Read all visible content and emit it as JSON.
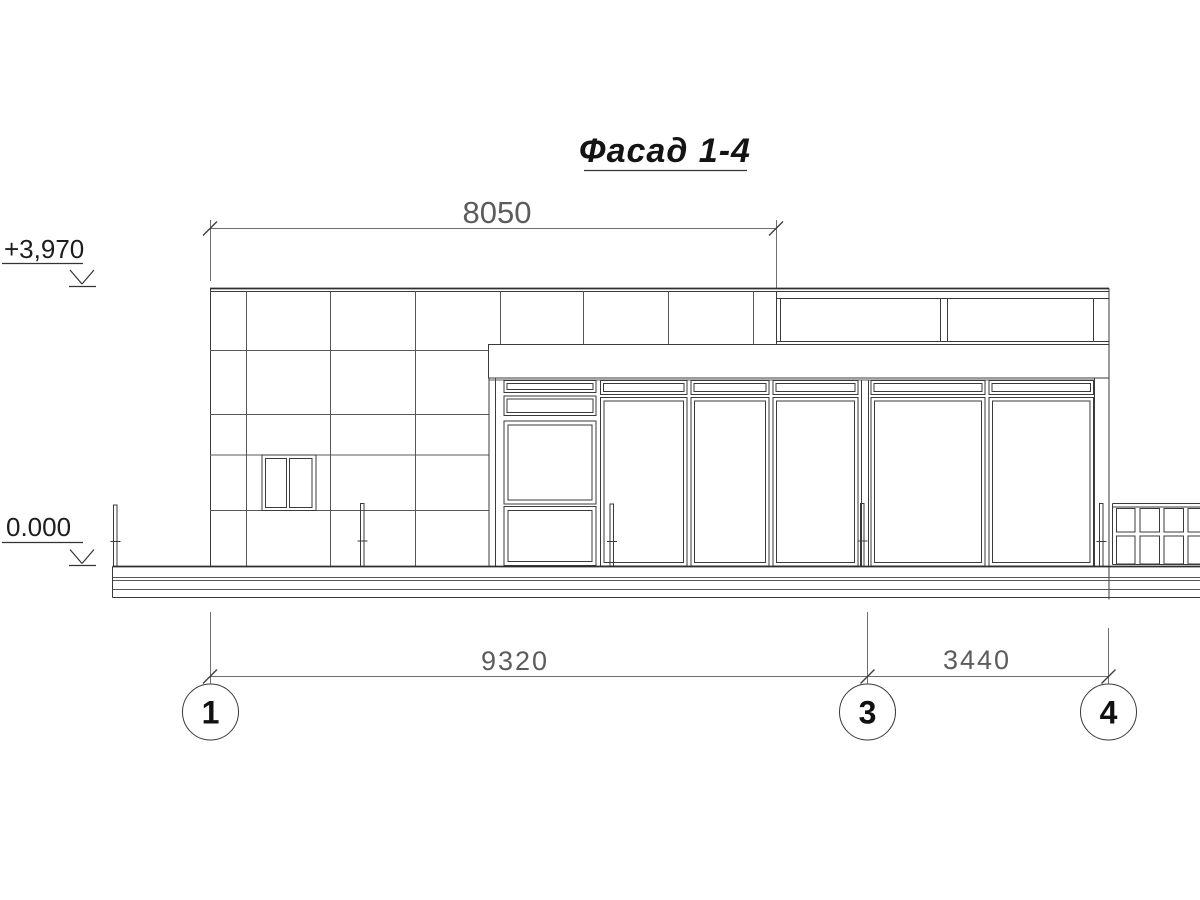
{
  "drawing_title": "Фасад 1-4",
  "dimensions": {
    "top_span": "8050",
    "axis_1_3_span": "9320",
    "axis_3_4_span": "3440"
  },
  "elevations": {
    "parapet_level": "+3,970",
    "ground_level": "0.000"
  },
  "axes": {
    "a1": "1",
    "a3": "3",
    "a4": "4"
  },
  "colors": {
    "background": "#ffffff",
    "line_main": "#3a3a3a",
    "line_panel": "#585858",
    "line_dimension": "#6f6f6f",
    "text_dimension": "#5c5c5c",
    "text_title": "#141414"
  }
}
